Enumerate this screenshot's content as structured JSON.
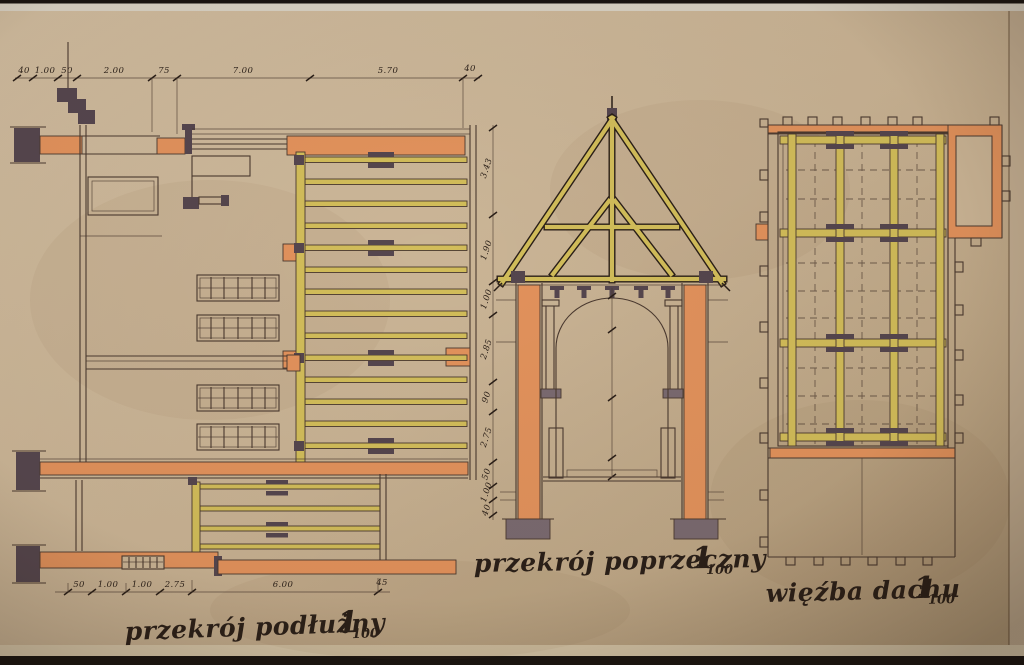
{
  "document": {
    "kind": "hand-drawn architectural plan photograph",
    "language": "Polish",
    "scale": "1:100"
  },
  "colors": {
    "paper": "#c9b394",
    "paper_edge": "#d9c9ab",
    "top_strip": "#d8d1c3",
    "photo_edge": "#181310",
    "ink": "#4a392f",
    "ink_dark": "#2a1f18",
    "brick": "#e2925c",
    "timber": "#d2bd5a",
    "darkfill": "#55464e",
    "footing": "#7a6a70"
  },
  "views": {
    "longitudinal_section": {
      "caption": "przekrój podłużny",
      "scale_big": "1",
      "scale_sub": "100",
      "top_dims": [
        "40",
        "1.00",
        "50",
        "2.00",
        "75",
        "7.00",
        "5.70",
        "40"
      ],
      "bottom_dims": [
        "50",
        "1.00",
        "1.00",
        "2.75",
        "6.00",
        "45"
      ],
      "side_dims": [
        "3.43",
        "1.90",
        "1.00",
        "2.85",
        "90",
        "2.75",
        "50",
        "1.00",
        "40"
      ]
    },
    "cross_section": {
      "caption": "przekrój poprzeczny",
      "scale_big": "1",
      "scale_sub": "100"
    },
    "roof_plan": {
      "caption": "więźba dachu",
      "scale_big": "1",
      "scale_sub": "100"
    }
  }
}
